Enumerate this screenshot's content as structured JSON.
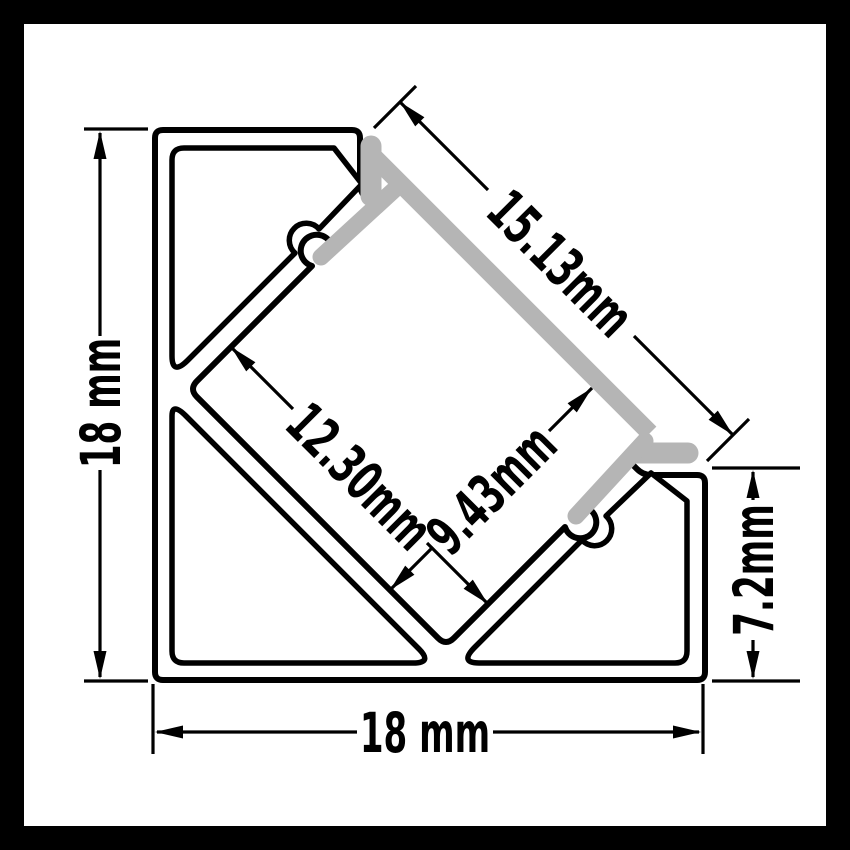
{
  "drawing": {
    "type_note": "technical cross-section drawing of aluminium LED corner profile",
    "colors": {
      "frame": "#000000",
      "background": "#ffffff",
      "outline": "#000000",
      "diffuser_gray": "#b5b5b5"
    }
  },
  "dimensions": {
    "overall_height": {
      "label": "18 mm"
    },
    "overall_width": {
      "label": "18 mm"
    },
    "diffuser_face": {
      "label": "15.13mm"
    },
    "channel_width": {
      "label": "12.30mm"
    },
    "channel_depth": {
      "label": "9.43mm"
    },
    "right_edge_height": {
      "label": "7.2mm"
    }
  }
}
